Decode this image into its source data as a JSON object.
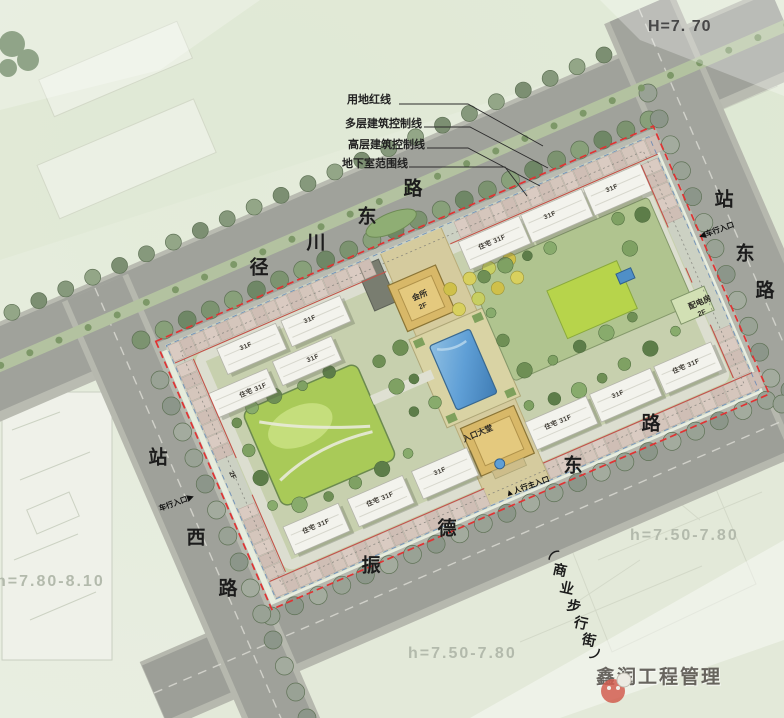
{
  "legend": {
    "items": [
      "用地红线",
      "多层建筑控制线",
      "高层建筑控制线",
      "地下室范围线"
    ]
  },
  "annotations": {
    "site_height": "H=7. 70",
    "elev_right": "h=7.50-7.80",
    "elev_bottom": "h=7.50-7.80",
    "elev_left": "h=7.80-8.10"
  },
  "roads": {
    "north": "径川东路",
    "east": "站东路",
    "south": "振德东路",
    "west": "站西路",
    "pedestrian": "（商业步行街）"
  },
  "entrances": {
    "east_arrow": "◀",
    "east_label": "车行入口",
    "west_label": "车行入口",
    "west_arrow": "▶",
    "south_arrow": "▲",
    "south_label": "人行主入口"
  },
  "facilities": {
    "clubhouse": "会所",
    "clubhouse_floors": "2F",
    "entrance_hall": "入口大堂",
    "power_room": "配电房",
    "power_room_floors": "2F",
    "shops_floors": "2F"
  },
  "residential": [
    "31F",
    "31F",
    "住宅 31F",
    "31F",
    "31F",
    "住宅 31F",
    "31F",
    "住宅 31F",
    "住宅 31F",
    "31F",
    "住宅 31F",
    "31F",
    "住宅 31F"
  ],
  "watermark": {
    "company": "鑫润工程管理"
  },
  "colors": {
    "boundary_red": "#e03333",
    "road_gray": "#a0a29b",
    "lawn_green": "#a9ca58",
    "water_blue": "#5f9fd6",
    "axis_tan": "#d5cb9e"
  }
}
